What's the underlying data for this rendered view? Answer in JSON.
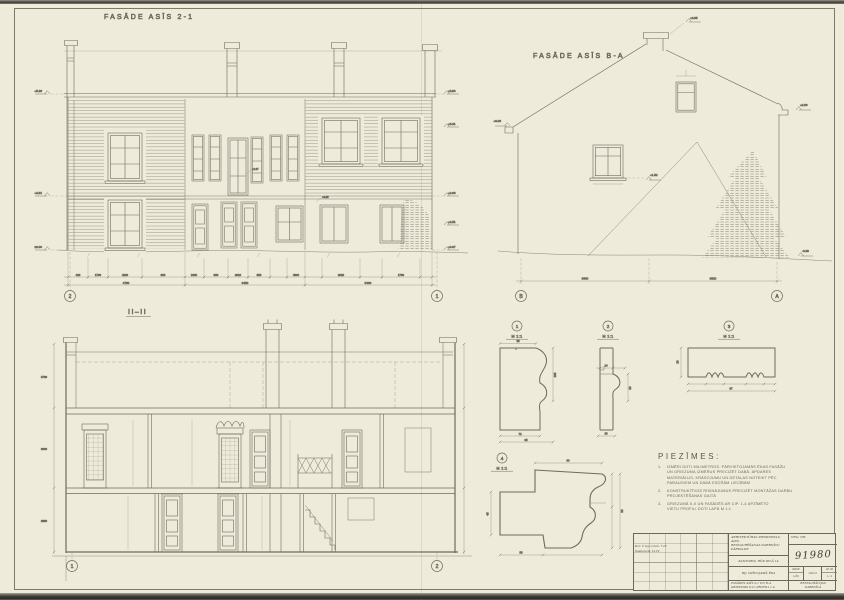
{
  "f21": {
    "title": "FASĀDE ASĪS 2-1",
    "axis_left": "2",
    "axis_right": "1",
    "dims_row1": [
      "410",
      "1700",
      "4200",
      "880",
      "2400",
      "880",
      "3010",
      "950",
      "4800",
      "3020",
      "1760"
    ],
    "dims_row2": [
      "4780",
      "6450",
      "5480"
    ],
    "levels_right": [
      "+5.80",
      "+5.31",
      "+2.98",
      "+2.51",
      "+0.07"
    ],
    "levels_left": [
      "+5.28",
      "+2.51",
      "±0.00"
    ],
    "callouts": [
      "+2.37",
      "+0.85"
    ]
  },
  "fba": {
    "title": "FASĀDE ASĪS B-A",
    "axis_left": "B",
    "axis_right": "A",
    "dims": [
      "6880",
      "6520"
    ],
    "level_ridge": "+6.85",
    "level_eave_left": "+3.06",
    "level_eave_right": "+2.80",
    "level_ground": "-0.38",
    "level_window": "+1.52"
  },
  "sec": {
    "title": "II–II",
    "axis_left": "1",
    "axis_right": "2",
    "dims": [
      "2780",
      "3300",
      "2850"
    ]
  },
  "details": [
    {
      "num": "1",
      "scale": "M 1:1",
      "dims": [
        "28",
        "105",
        "72",
        "95"
      ]
    },
    {
      "num": "2",
      "scale": "M 1:1",
      "dims": [
        "14",
        "30",
        "26"
      ]
    },
    {
      "num": "3",
      "scale": "M 1:1",
      "dims": [
        "29",
        "87"
      ]
    },
    {
      "num": "4",
      "scale": "M 1:1",
      "dims": [
        "90",
        "45",
        "58",
        "80"
      ]
    }
  ],
  "notes": {
    "heading": "PIEZĪMES:",
    "items": [
      {
        "num": "1.",
        "lines": [
          "IZMĒRI DOTI MILIMETROS. PĀRVIETOJAMĀS ĒKAS FASĀŽU",
          "UN GRIEZUMA IZMĒRUS PRECIZĒT DABĀ. APDARES",
          "MATERIĀLUS, KRĀSOJUMU UN DETAĻAS NOTEIKT PĒC",
          "PARAUGIEM UN DABĀ ESOŠĀM LIECĪBĀM"
        ]
      },
      {
        "num": "2.",
        "lines": [
          "KONSTRUKTĪVOS RISINĀJUMUS PRECIZĒT MONTĀŽAS DARBU",
          "PROJEKTĒŠANAS GAITĀ"
        ]
      },
      {
        "num": "3.",
        "lines": [
          "GRIEZUMĀ II-II UN FASĀDĒS AR CIP. 1-4 APZĪMĒTO",
          "VIETU PROFILI DOTI LAPĀ M 1:1"
        ]
      }
    ]
  },
  "titleblock": {
    "rev_entry1": "Kor. 2 lap. izlab. 7.IV",
    "rev_entry2": "Saskaņots 12.IV",
    "org_line1": "ARHITEKTŪRAS PIEMINEKĻU AIZS.",
    "org_line2": "RESTAURĒŠANAS DARBNĪCU PĀRVALDE",
    "neg_label": "NEG. NR.",
    "object": "KANTORIS, RŪP. IELĀ 14",
    "stamp": "91980",
    "subject": "BIJ. DZĪVOJAMĀ ĒKA",
    "cell_grup": "GRUP",
    "cell_lun": "LŪN",
    "cell_code": "102-3",
    "cell_lp": "LP. 20",
    "cell_l": "L. 4",
    "sheet_title1": "FASĀDES ASĪS 2-1 UN B-A",
    "sheet_title2": "GRIEZUMS II-II, PROFILI 1-4",
    "firm1": "RESTAURĀCIJAS",
    "firm2": "DARBNĪCA"
  }
}
